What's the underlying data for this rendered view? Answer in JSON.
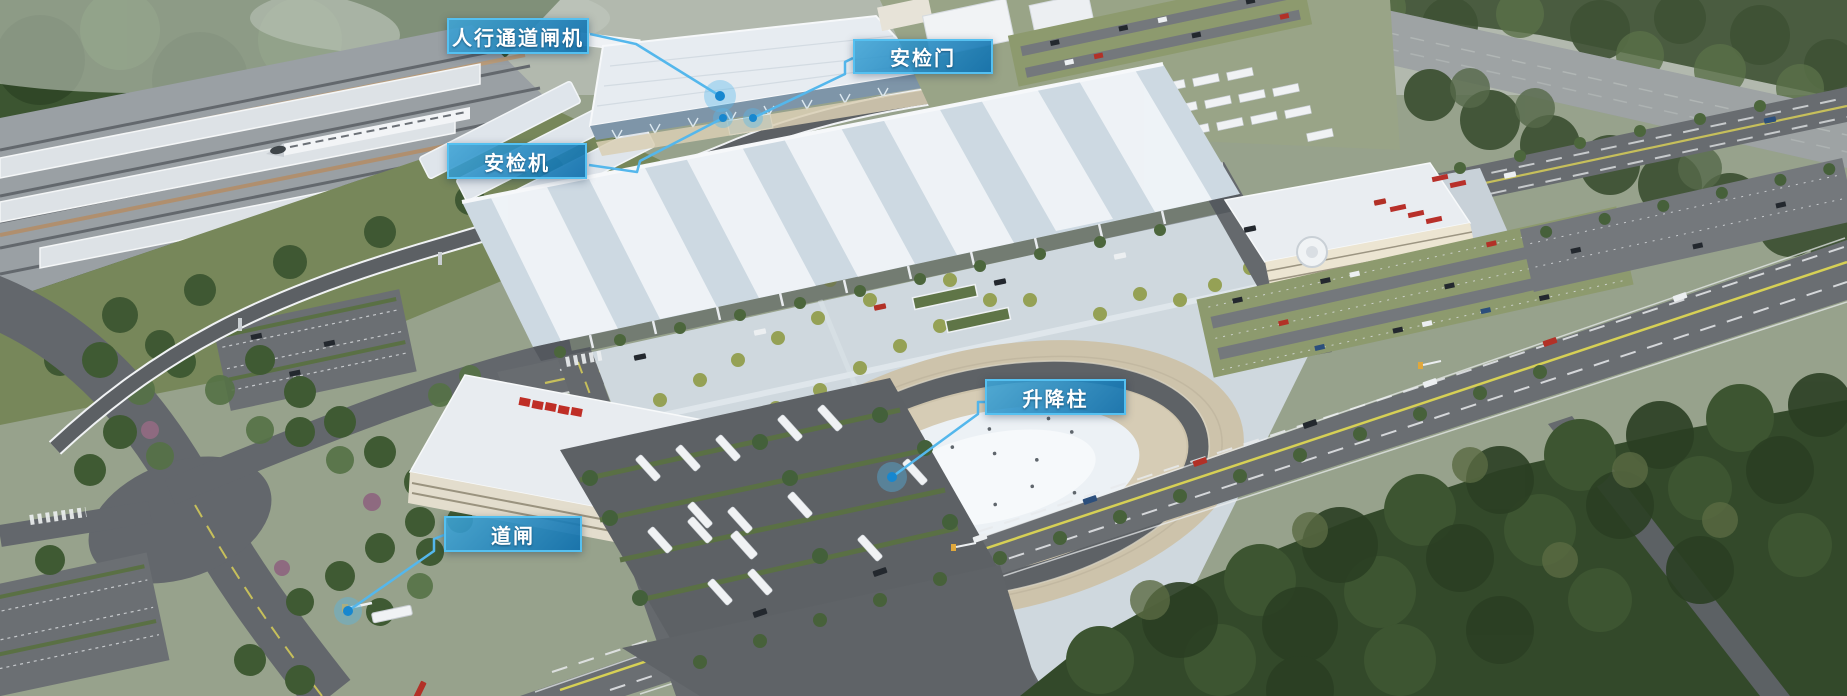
{
  "image": {
    "width": 1847,
    "height": 696
  },
  "colors": {
    "label_border": "#55c0f0",
    "label_fill_top": "#3ea4d6",
    "label_fill_bottom": "#1070ad",
    "label_text": "#ffffff",
    "leader_line": "#54b7ec",
    "dot_fill": "#1787cf",
    "dot_halo": "rgba(84,183,236,0.38)"
  },
  "annotations": {
    "labels": [
      {
        "id": "pedestrian-channel-gate",
        "text": "人行通道闸机",
        "box": {
          "x": 447,
          "y": 18,
          "w": 142,
          "h": 36
        },
        "line": [
          [
            590,
            34
          ],
          [
            636,
            44
          ],
          [
            720,
            96
          ]
        ],
        "dot": {
          "x": 720,
          "y": 96,
          "r": 5,
          "halo": 16
        }
      },
      {
        "id": "security-door",
        "text": "安检门",
        "box": {
          "x": 853,
          "y": 39,
          "w": 140,
          "h": 35
        },
        "line": [
          [
            853,
            58
          ],
          [
            845,
            62
          ],
          [
            845,
            74
          ],
          [
            753,
            118
          ]
        ],
        "dot": {
          "x": 753,
          "y": 118,
          "r": 4,
          "halo": 10
        }
      },
      {
        "id": "security-scanner",
        "text": "安检机",
        "box": {
          "x": 447,
          "y": 143,
          "w": 140,
          "h": 36
        },
        "line": [
          [
            589,
            165
          ],
          [
            637,
            172
          ],
          [
            640,
            161
          ],
          [
            723,
            118
          ]
        ],
        "dot": {
          "x": 723,
          "y": 118,
          "r": 4,
          "halo": 10
        }
      },
      {
        "id": "lifting-bollard",
        "text": "升降柱",
        "box": {
          "x": 985,
          "y": 379,
          "w": 141,
          "h": 36
        },
        "line": [
          [
            986,
            402
          ],
          [
            978,
            402
          ],
          [
            978,
            414
          ],
          [
            892,
            477
          ]
        ],
        "dot": {
          "x": 892,
          "y": 477,
          "r": 5,
          "halo": 15
        }
      },
      {
        "id": "road-barrier-gate",
        "text": "道闸",
        "box": {
          "x": 444,
          "y": 516,
          "w": 138,
          "h": 36
        },
        "line": [
          [
            444,
            535
          ],
          [
            434,
            539
          ],
          [
            434,
            551
          ],
          [
            348,
            611
          ]
        ],
        "dot": {
          "x": 348,
          "y": 611,
          "r": 5,
          "halo": 14
        }
      }
    ]
  }
}
